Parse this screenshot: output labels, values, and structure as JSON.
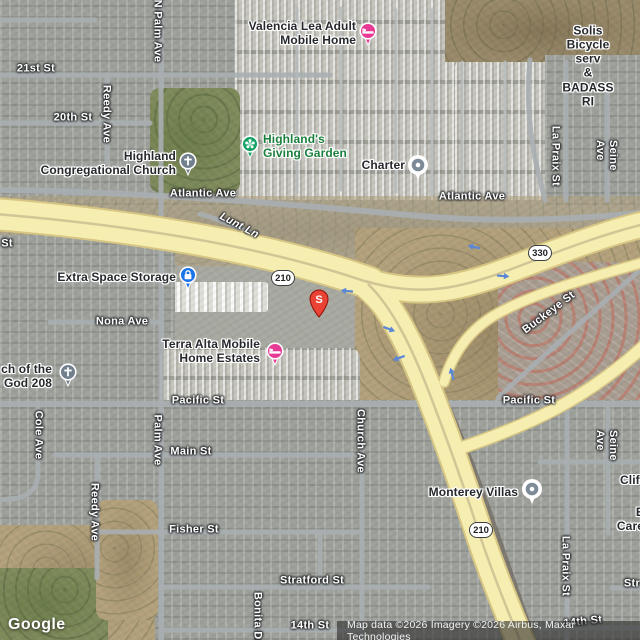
{
  "brand": {
    "logo": "Google"
  },
  "attribution": {
    "text": "Map data ©2026 Imagery ©2026 Airbus, Maxar Technologies"
  },
  "marker": {
    "label": "S"
  },
  "shields": {
    "s210_west": "210",
    "s330": "330",
    "s210_south": "210"
  },
  "streets": {
    "st21": "21st St",
    "st20": "20th St",
    "n_palm_ave": "N Palm Ave",
    "reedy_ave_top": "Reedy Ave",
    "atlantic_left": "Atlantic Ave",
    "atlantic_right": "Atlantic Ave",
    "lunt_ln": "Lunt Ln",
    "st_partial": "St",
    "nona_ave": "Nona Ave",
    "pacific_left": "Pacific St",
    "pacific_right": "Pacific St",
    "main_st": "Main St",
    "fisher_st": "Fisher St",
    "cole_ave": "Cole Ave",
    "palm_ave": "Palm Ave",
    "reedy_ave_bottom": "Reedy Ave",
    "church_ave": "Church Ave",
    "buckeye_st": "Buckeye St",
    "la_praix_top": "La Praix St",
    "seine_top": "Seine Ave",
    "la_praix_bottom": "La Praix St",
    "seine_bottom": "Seine Ave",
    "stratford_st": "Stratford St",
    "stratford_partial": "Str",
    "fourteenth_st": "14th St",
    "fourteenth_right": "14th St",
    "bonita_dr": "Bonita Dr"
  },
  "pois": {
    "valencia": "Valencia Lea Adult\nMobile Home",
    "giving_garden": "Highland's\nGiving Garden",
    "congregational": "Highland\nCongregational Church",
    "charter": "Charter",
    "extra_space": "Extra Space Storage",
    "terra_alta": "Terra Alta Mobile\nHome Estates",
    "church_god": "ch of the\nGod 208",
    "monterey": "Monterey Villas",
    "solis": "Solis Bicycle serv\n& BADASS RI",
    "clift_partial": "Clift",
    "care_partial": "E\nCare"
  },
  "colors": {
    "freeway_fill": "#f6edb0",
    "freeway_casing": "#d6c583",
    "road": "#a9aeb1",
    "pin_pink": "#e73a95",
    "pin_blue": "#1a73e8",
    "pin_slate": "#72808d",
    "pin_inner_gray": "#7d8b98",
    "marker_red": "#ea4335",
    "poi_green_text": "#1b7f3c",
    "arrow_blue": "#5b87d6"
  }
}
